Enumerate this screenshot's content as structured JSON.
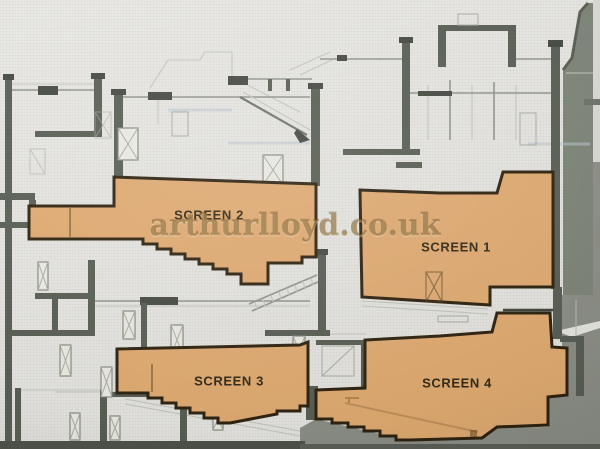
{
  "meta": {
    "title": "Cinema cross-section drawing with four auditoria highlighted"
  },
  "watermark": {
    "text": "arthurlloyd.co.uk"
  },
  "screens": [
    {
      "label": "SCREEN 1"
    },
    {
      "label": "SCREEN 2"
    },
    {
      "label": "SCREEN 3"
    },
    {
      "label": "SCREEN 4"
    }
  ],
  "colors": {
    "paper": "#e8e7e3",
    "wall": "#555b51",
    "auditorium_fill": "#e2aa6f",
    "auditorium_outline": "#2a1d0a",
    "shading_olive": "#7b8275",
    "shading_gray": "#8a8d84",
    "label_text": "#2f2612",
    "watermark_gold": "#946828"
  }
}
